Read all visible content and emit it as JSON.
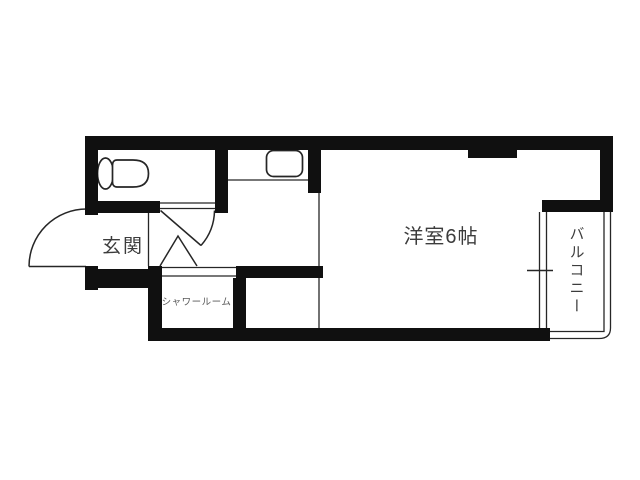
{
  "colors": {
    "wall": "#101010",
    "line": "#262626",
    "text": "#3c3c3c",
    "text_small": "#575757",
    "background": "#ffffff"
  },
  "labels": {
    "entrance": "玄関",
    "western_room": "洋室6帖",
    "shower_room": "シャワールーム",
    "balcony": "バルコニー"
  },
  "icons": {
    "toilet": "toilet-icon",
    "kitchen_sink": "kitchen-sink-icon",
    "entrance_door": "door-swing-icon",
    "toilet_door": "door-swing-icon",
    "shower_door": "folding-door-icon",
    "window": "sliding-window-icon"
  }
}
